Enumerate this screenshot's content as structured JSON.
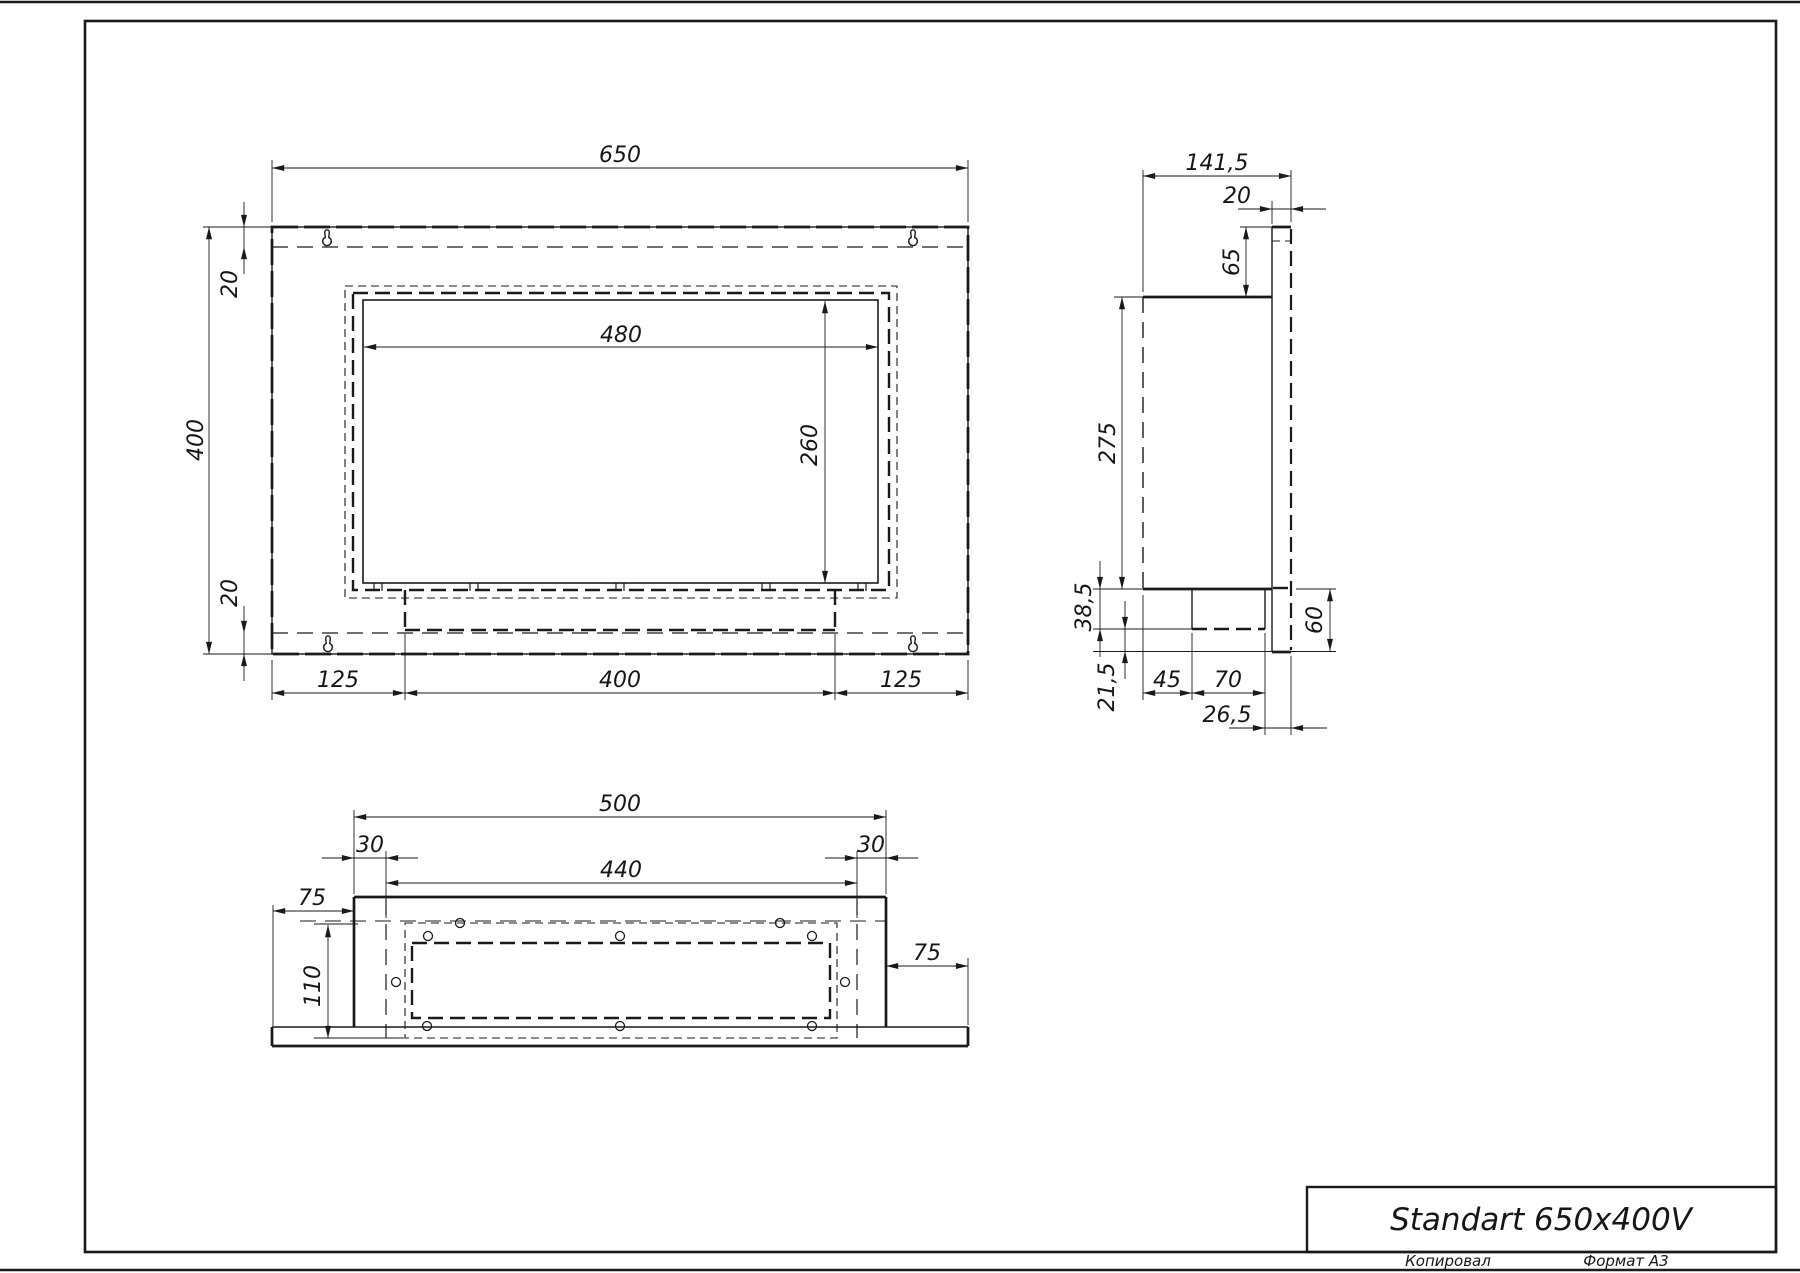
{
  "sheet": {
    "copied_label": "Копировал",
    "format_label": "Формат А3"
  },
  "title_block": {
    "product_title": "Standart 650x400V"
  },
  "front_view": {
    "dims": {
      "overall_width": "650",
      "overall_height": "400",
      "top_offset": "20",
      "bottom_offset": "20",
      "opening_width": "480",
      "opening_height": "260",
      "bottom_left": "125",
      "bottom_center": "400",
      "bottom_right": "125"
    }
  },
  "side_view": {
    "dims": {
      "overall_depth": "141,5",
      "frame_depth": "20",
      "top_inset": "65",
      "body_height": "275",
      "lower_step": "38,5",
      "lower_gap": "21,5",
      "front_gap": "45",
      "burner_depth": "70",
      "back_gap": "26,5",
      "lower_height": "60"
    }
  },
  "bottom_view": {
    "dims": {
      "body_width": "500",
      "left_inset": "30",
      "inner_width": "440",
      "right_inset": "30",
      "left_flange": "75",
      "right_flange": "75",
      "body_depth": "110"
    }
  },
  "colors": {
    "line": "#1a1a1a",
    "paper": "#ffffff"
  }
}
